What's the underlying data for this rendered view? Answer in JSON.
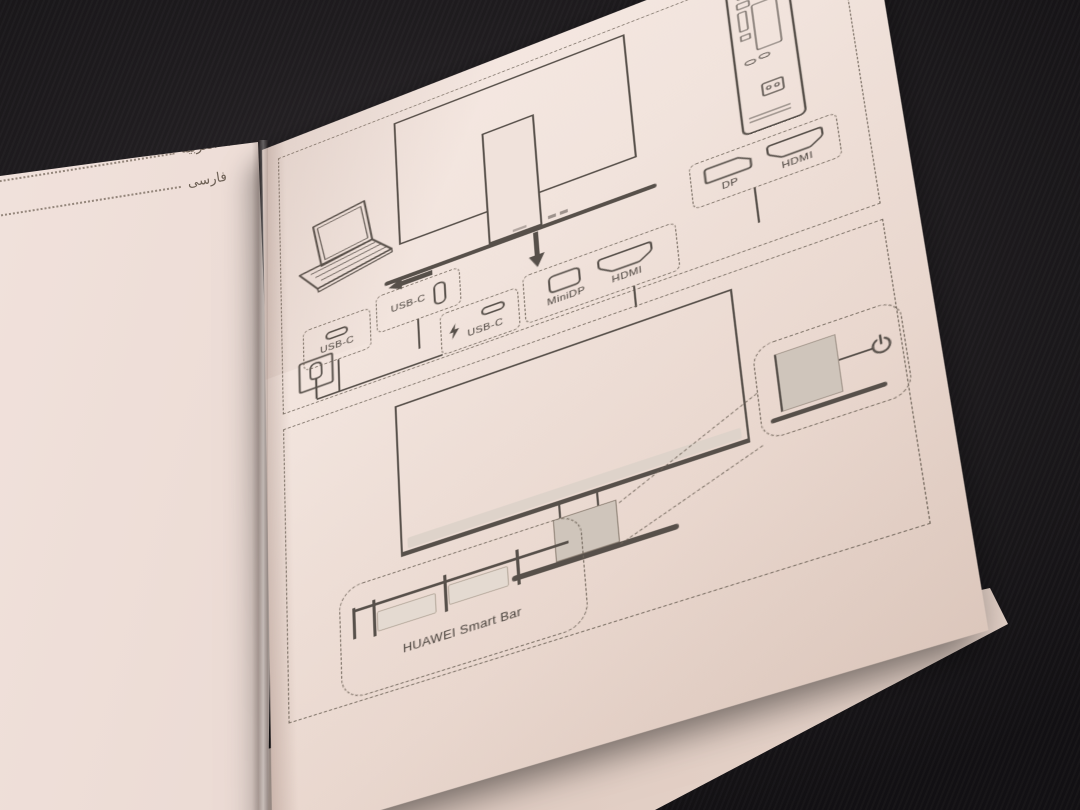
{
  "scene": {
    "background_color": "#151317",
    "paper_color": "#efe1da",
    "ink_color": "#57504a"
  },
  "left_page": {
    "toc": [
      {
        "label": "اللغة العربية"
      },
      {
        "label": "فارسی"
      }
    ]
  },
  "right_page": {
    "panel1": {
      "laptop_port_label": "USB-C",
      "monitor_port_label": "USB-C",
      "power_port_label": "USB-C",
      "minidp_label": "MiniDP",
      "hdmi_label": "HDMI",
      "pc_dp_label": "DP",
      "pc_hdmi_label": "HDMI"
    },
    "panel2": {
      "smartbar_label": "HUAWEI Smart Bar"
    },
    "icons": {
      "lightning": "⚡",
      "power": "⏻",
      "arrow_left": "◄",
      "arrow_down": "▼",
      "power_outlet": "outlet"
    }
  }
}
